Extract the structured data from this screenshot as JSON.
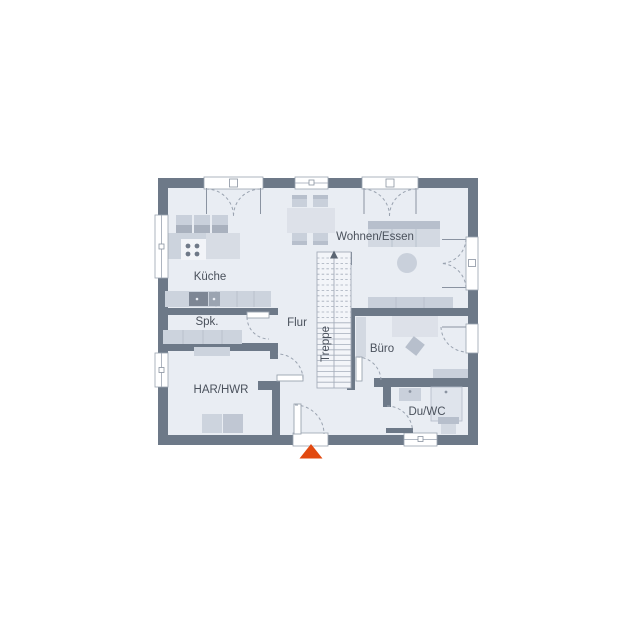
{
  "plan": {
    "title_hint": "ground-floor plan",
    "rooms": [
      {
        "id": "kueche",
        "label": "Küche"
      },
      {
        "id": "spk",
        "label": "Spk."
      },
      {
        "id": "flur",
        "label": "Flur"
      },
      {
        "id": "har_hwr",
        "label": "HAR/HWR"
      },
      {
        "id": "treppe",
        "label": "Treppe"
      },
      {
        "id": "wohnen_essen",
        "label": "Wohnen/Essen"
      },
      {
        "id": "buero",
        "label": "Büro"
      },
      {
        "id": "du_wc",
        "label": "Du/WC"
      }
    ],
    "markers": {
      "entrance_arrow": "triangle-up-entrance-marker",
      "stair_direction": "up"
    },
    "colors": {
      "wall": "#6d7988",
      "floor": "#e9edf3",
      "furniture_light": "#dde1e9",
      "furniture_mid": "#ccd3dd",
      "furniture_dark": "#b7bfcc",
      "symbol_line": "#9aa3b0",
      "text": "#4a515c",
      "entrance_arrow": "#e2490f",
      "background": "#ffffff"
    }
  }
}
